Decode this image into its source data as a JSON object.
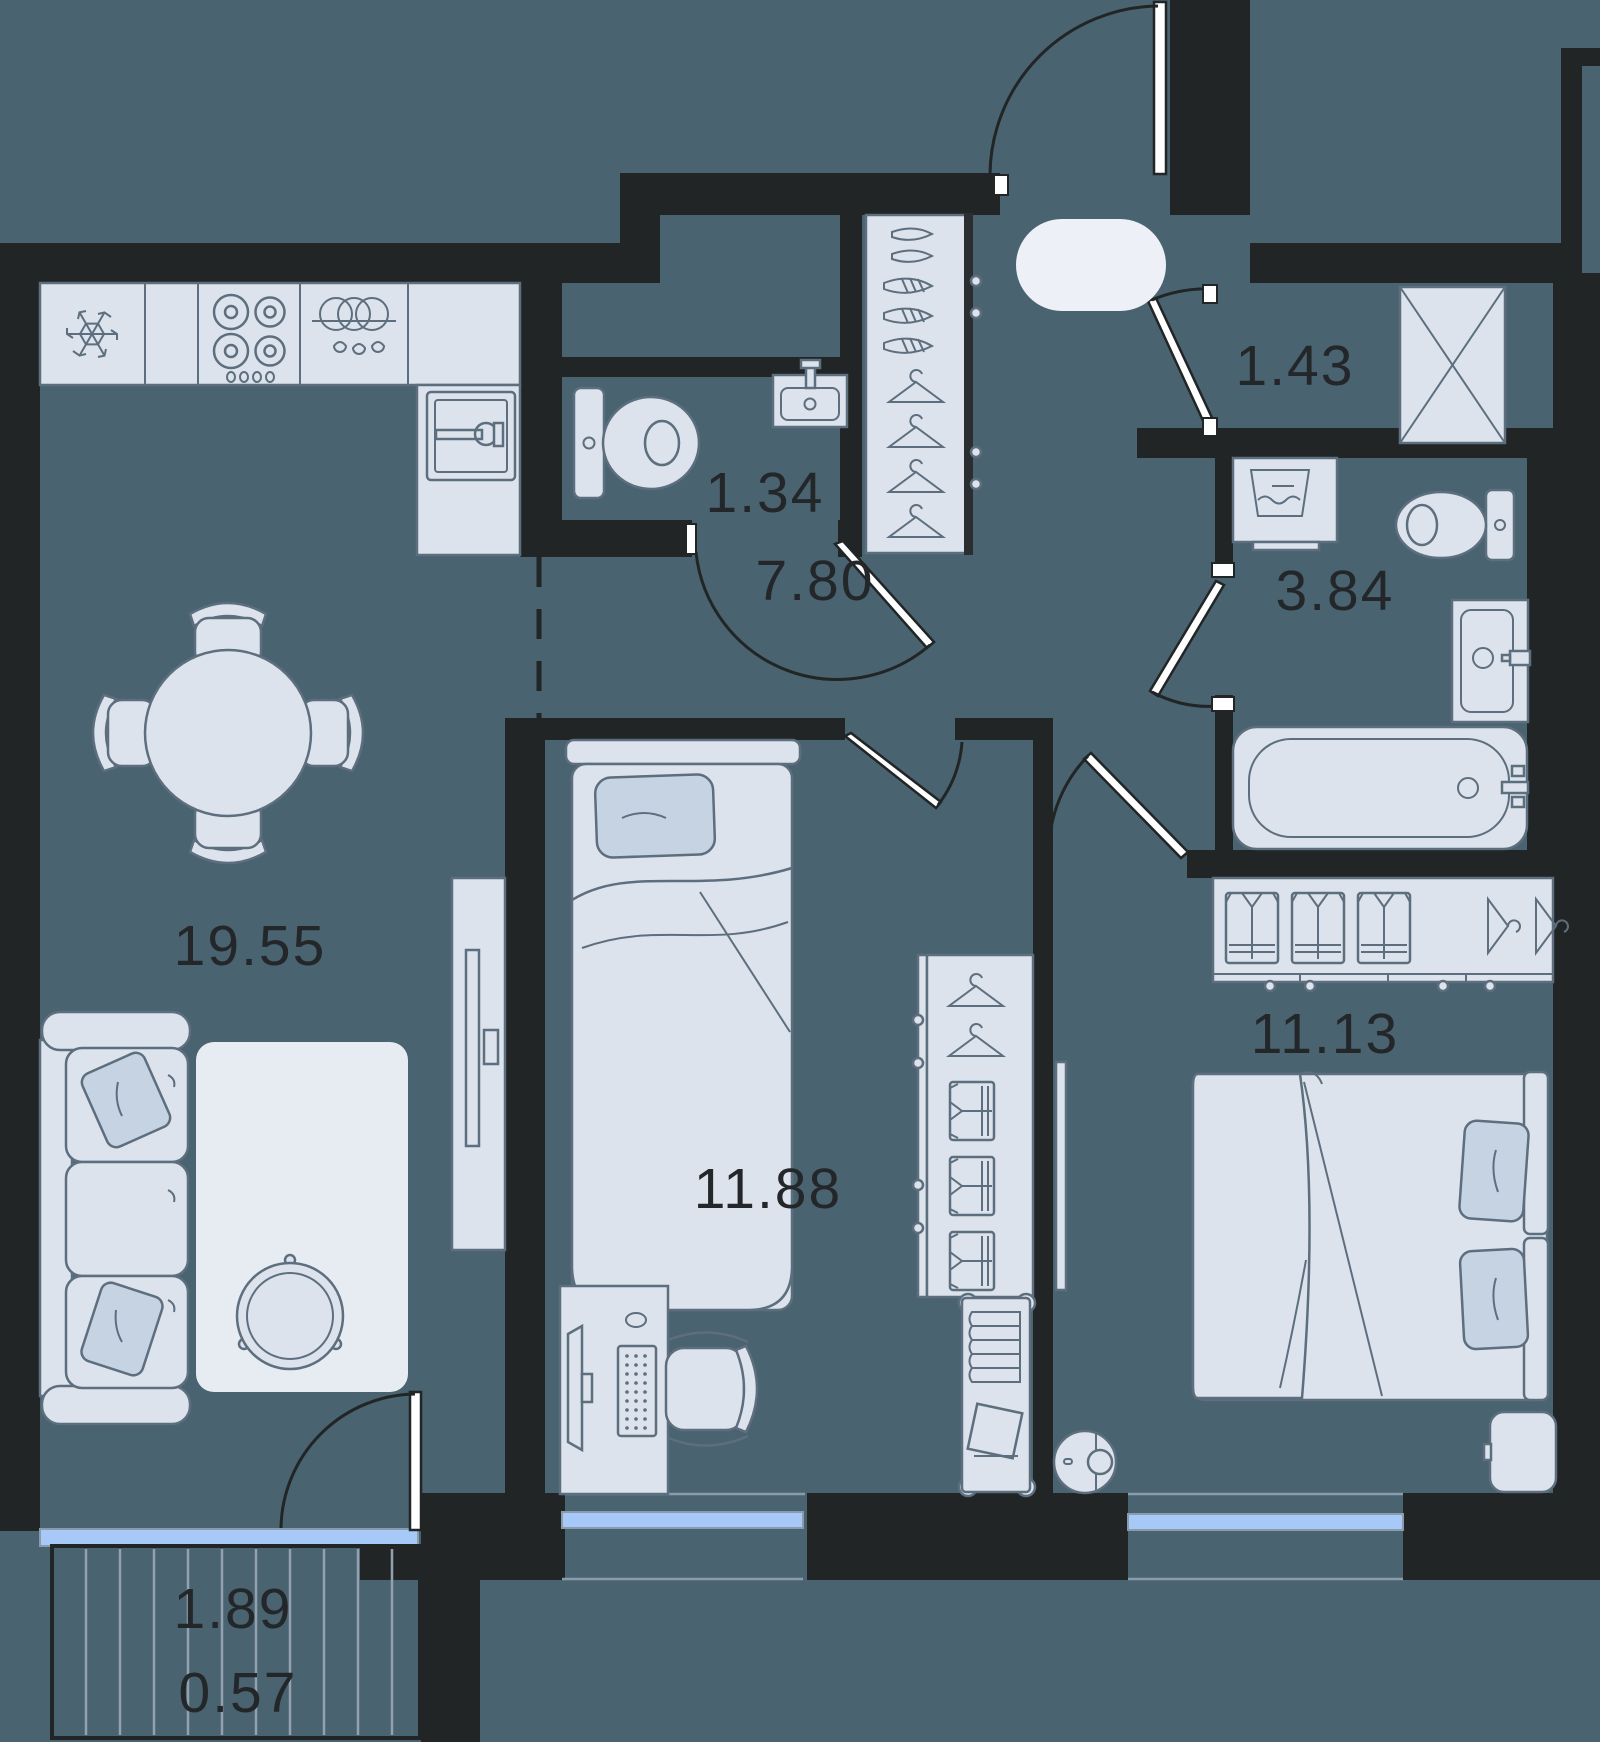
{
  "title": "2-room apartment floor plan",
  "units": "m2",
  "colors": {
    "floor": "#4A6370",
    "wall": "#212525",
    "furniture": "#DCE3EC",
    "accent": "#C6D3E2",
    "outline": "#5D6E7E",
    "window": "#A6C9F8",
    "glassline": "#8A9CAB",
    "label": "#232729",
    "mat": "#EDF1F7",
    "rug": "#E7ECF3"
  },
  "rooms": {
    "living_kitchen": {
      "name": "kitchen-living room",
      "area": "19.55"
    },
    "hallway": {
      "name": "hallway",
      "area": "7.80"
    },
    "wc": {
      "name": "guest wc",
      "area": "1.34"
    },
    "storage": {
      "name": "storage",
      "area": "1.43"
    },
    "bathroom": {
      "name": "bathroom",
      "area": "3.84"
    },
    "bedroom1": {
      "name": "bedroom",
      "area": "11.88"
    },
    "bedroom2": {
      "name": "master bedroom",
      "area": "11.13"
    },
    "balcony": {
      "name": "balcony",
      "area_full": "1.89",
      "area_counted": "0.57"
    }
  },
  "icons": [
    "fridge-snowflake-icon",
    "stove-burners-icon",
    "dishwasher-icon",
    "kitchen-sink-icon",
    "toilet-icon",
    "wall-sink-icon",
    "washing-machine-icon",
    "bathtub-icon",
    "bathroom-sink-icon",
    "wardrobe-hanger-icon",
    "folded-shirt-icon",
    "shoes-icon",
    "dining-table-icon",
    "sofa-icon",
    "coffee-table-icon",
    "tv-console-icon",
    "single-bed-icon",
    "double-bed-icon",
    "desk-computer-icon",
    "office-chair-icon",
    "robot-vacuum-icon",
    "book-trolley-icon",
    "nightstand-icon",
    "storage-crossbox-icon"
  ]
}
